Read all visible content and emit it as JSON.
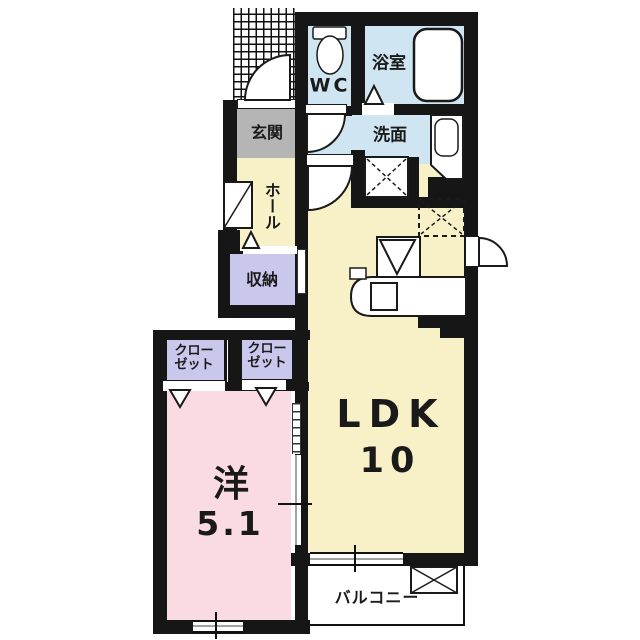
{
  "floorplan": {
    "rooms": {
      "wc": {
        "label": "WC"
      },
      "bathroom": {
        "label": "浴室"
      },
      "washroom": {
        "label": "洗面"
      },
      "entrance": {
        "label": "玄関"
      },
      "hall": {
        "label": "ホール"
      },
      "storage": {
        "label": "収納"
      },
      "closet_left": {
        "line1": "クロー",
        "line2": "ゼット"
      },
      "closet_right": {
        "line1": "クロー",
        "line2": "ゼット"
      },
      "western_room": {
        "label": "洋",
        "size": "5.1"
      },
      "ldk": {
        "label": "LDK",
        "size": "10"
      },
      "balcony": {
        "label": "バルコニー"
      }
    },
    "icons": {
      "toilet": "toilet-icon",
      "bathtub": "bathtub-icon",
      "vanity_sink": "vanity-sink-icon",
      "washing_machine_space": "washing-machine-space-icon",
      "refrigerator_space": "refrigerator-space-icon",
      "stove": "stove-icon",
      "kitchen_counter": "kitchen-counter-icon",
      "kitchen_sink": "kitchen-sink-icon",
      "ac_outdoor_unit": "ac-outdoor-unit-icon",
      "shoe_cabinet": "shoe-cabinet-icon",
      "entrance_porch": "entrance-porch-hatch"
    },
    "colors": {
      "wall": "#161616",
      "water_area": "#cfe5f1",
      "living_area": "#f8f1c8",
      "bedroom": "#fadbe4",
      "storage_area": "#c9c7ec",
      "entrance_floor": "#b5b5b5",
      "background": "#ffffff"
    }
  }
}
